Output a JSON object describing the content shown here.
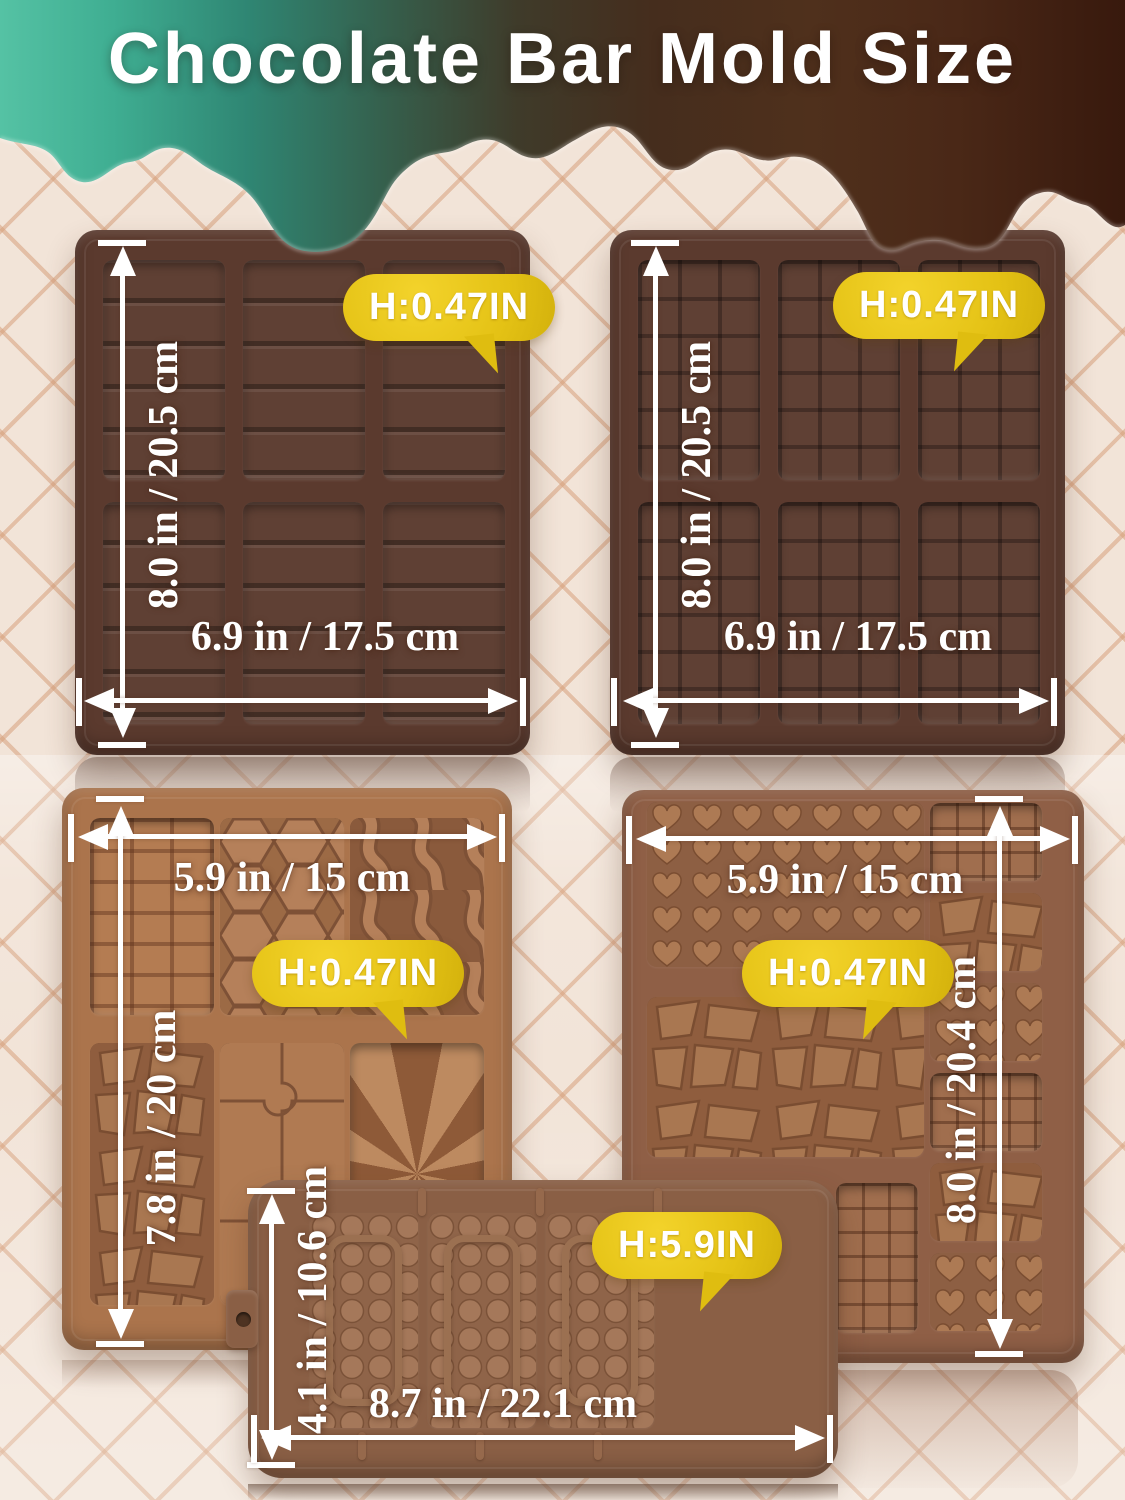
{
  "title": "Chocolate Bar Mold Size",
  "molds": {
    "top_left": {
      "width_label": "6.9 in / 17.5 cm",
      "height_label": "8.0 in / 20.5 cm",
      "depth_badge": "H:0.47IN"
    },
    "top_right": {
      "width_label": "6.9 in / 17.5 cm",
      "height_label": "8.0 in / 20.5 cm",
      "depth_badge": "H:0.47IN"
    },
    "middle_left": {
      "width_label": "5.9 in / 15 cm",
      "height_label": "7.8 in / 20 cm",
      "depth_badge": "H:0.47IN"
    },
    "middle_right": {
      "width_label": "5.9 in / 15 cm",
      "height_label": "8.0 in / 20.4 cm",
      "depth_badge": "H:0.47IN"
    },
    "bottom": {
      "width_label": "8.7 in / 22.1 cm",
      "height_label": "4.1 in / 10.6 cm",
      "depth_badge": "H:5.9IN"
    }
  },
  "colors": {
    "badge_yellow": "#e4c215",
    "mold_dark_brown": "#5b3a2e",
    "mold_caramel": "#ab744c",
    "mold_medium_brown": "#8f5f46",
    "mold_bottom_brown": "#8a5f45",
    "drip_teal": "#45b394",
    "drip_chocolate": "#3f2113",
    "background_cream": "#f2e4d8",
    "lattice_line": "#d7a07c",
    "dimension_text": "#ffffff"
  }
}
